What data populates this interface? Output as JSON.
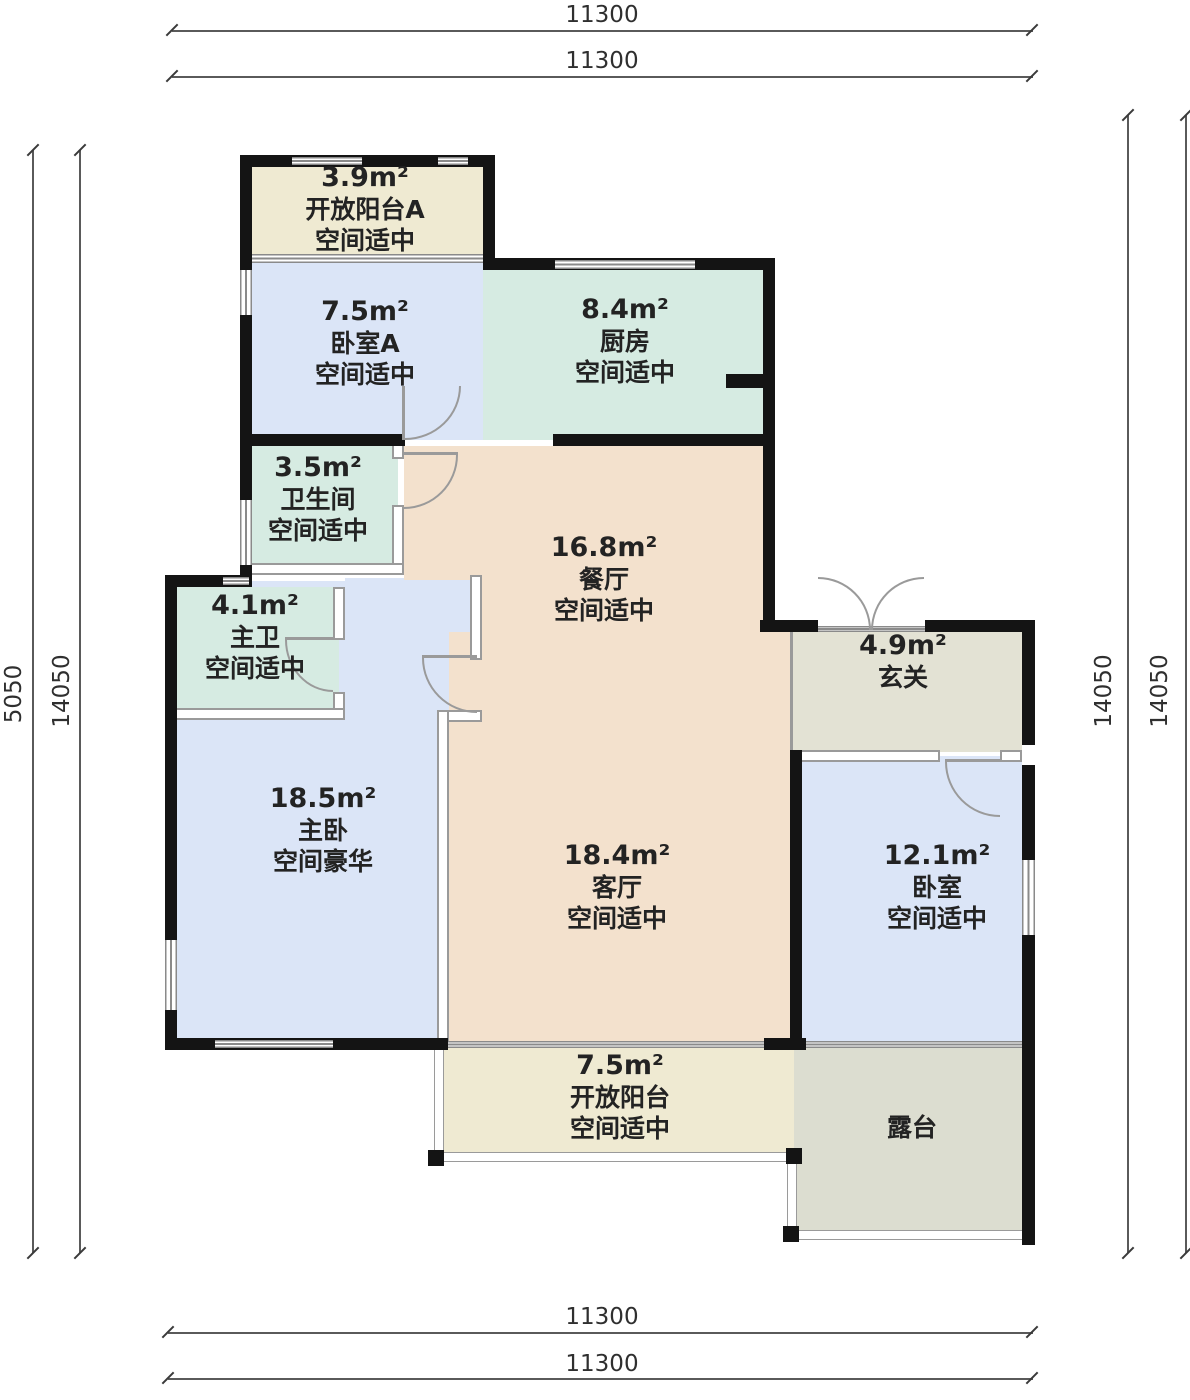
{
  "dimensions": {
    "top": [
      "11300",
      "11300"
    ],
    "bottom": [
      "11300",
      "11300"
    ],
    "left_outer": "5050",
    "left_inner": "14050",
    "right_inner": "14050",
    "right_outer": "14050"
  },
  "rooms": {
    "balcony_a": {
      "area": "3.9m²",
      "name": "开放阳台A",
      "desc": "空间适中"
    },
    "bedroom_a": {
      "area": "7.5m²",
      "name": "卧室A",
      "desc": "空间适中"
    },
    "kitchen": {
      "area": "8.4m²",
      "name": "厨房",
      "desc": "空间适中"
    },
    "bathroom": {
      "area": "3.5m²",
      "name": "卫生间",
      "desc": "空间适中"
    },
    "dining": {
      "area": "16.8m²",
      "name": "餐厅",
      "desc": "空间适中"
    },
    "master_bath": {
      "area": "4.1m²",
      "name": "主卫",
      "desc": "空间适中"
    },
    "entry": {
      "area": "4.9m²",
      "name": "玄关",
      "desc": ""
    },
    "master_bedroom": {
      "area": "18.5m²",
      "name": "主卧",
      "desc": "空间豪华"
    },
    "living": {
      "area": "18.4m²",
      "name": "客厅",
      "desc": "空间适中"
    },
    "bedroom": {
      "area": "12.1m²",
      "name": "卧室",
      "desc": "空间适中"
    },
    "balcony": {
      "area": "7.5m²",
      "name": "开放阳台",
      "desc": "空间适中"
    },
    "terrace": {
      "area": "",
      "name": "露台",
      "desc": ""
    }
  },
  "colors": {
    "bedroom_fill": "#dbe5f7",
    "kitchen_bath_fill": "#d6ebe2",
    "living_dining_fill": "#f3e1cd",
    "balcony_fill": "#efead2",
    "entry_fill": "#e3e2d4",
    "terrace_fill": "#dcddd0",
    "wall": "#141414",
    "partition": "#9a9a9a"
  }
}
